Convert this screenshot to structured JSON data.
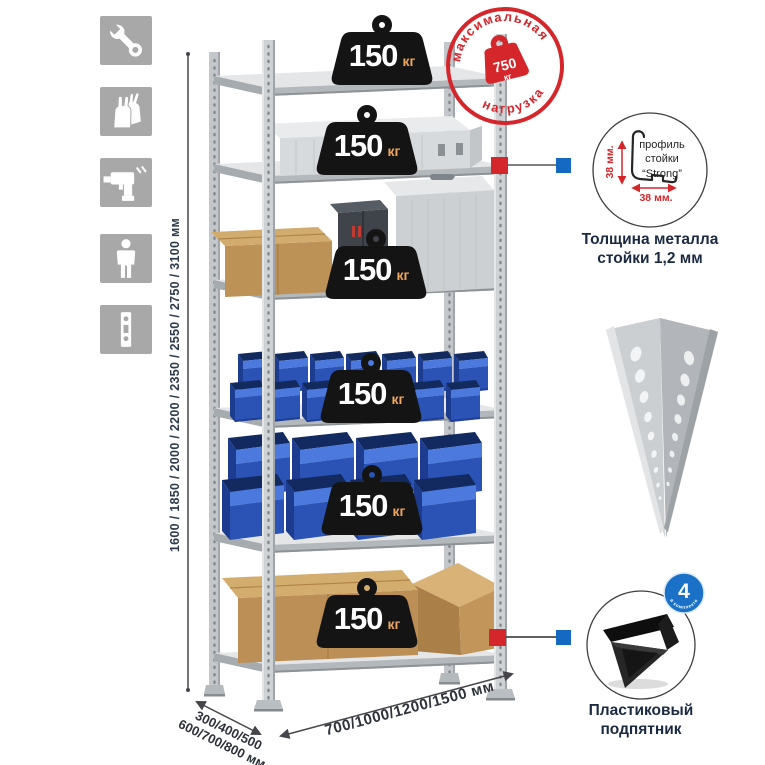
{
  "sidebar_icons": [
    {
      "name": "wrench"
    },
    {
      "name": "gloves"
    },
    {
      "name": "drill"
    },
    {
      "name": "person"
    },
    {
      "name": "perforated-post"
    }
  ],
  "height_dimension": {
    "label": "1600 / 1850 / 2000 / 2200 / 2350 / 2550 / 2750 / 3100 мм"
  },
  "shelf_badge": {
    "value": "150",
    "unit": "кг"
  },
  "max_load_stamp": {
    "arc_top": "максимальная",
    "arc_bottom": "нагрузка",
    "value": "750",
    "unit": "кг"
  },
  "profile_detail": {
    "vertical_dim": "38 мм.",
    "horizontal_dim": "38 мм.",
    "label_line1": "профиль",
    "label_line2": "стойки",
    "label_line3": "“Strong”",
    "caption_line1": "Толщина металла",
    "caption_line2": "стойки 1,2 мм"
  },
  "foot_detail": {
    "badge_value": "4",
    "badge_text": "в комплекте",
    "caption_line1": "Пластиковый",
    "caption_line2": "подпятник"
  },
  "depth_dimension": {
    "line1": "300/400/500",
    "line2": "600/700/800 мм"
  },
  "width_dimension": {
    "label": "700/1000/1200/1500 мм"
  },
  "colors": {
    "accent_red": "#d5262b",
    "accent_blue": "#1569c2",
    "metal_gray": "#c9cdd0",
    "bin_blue": "#2a53b5"
  }
}
